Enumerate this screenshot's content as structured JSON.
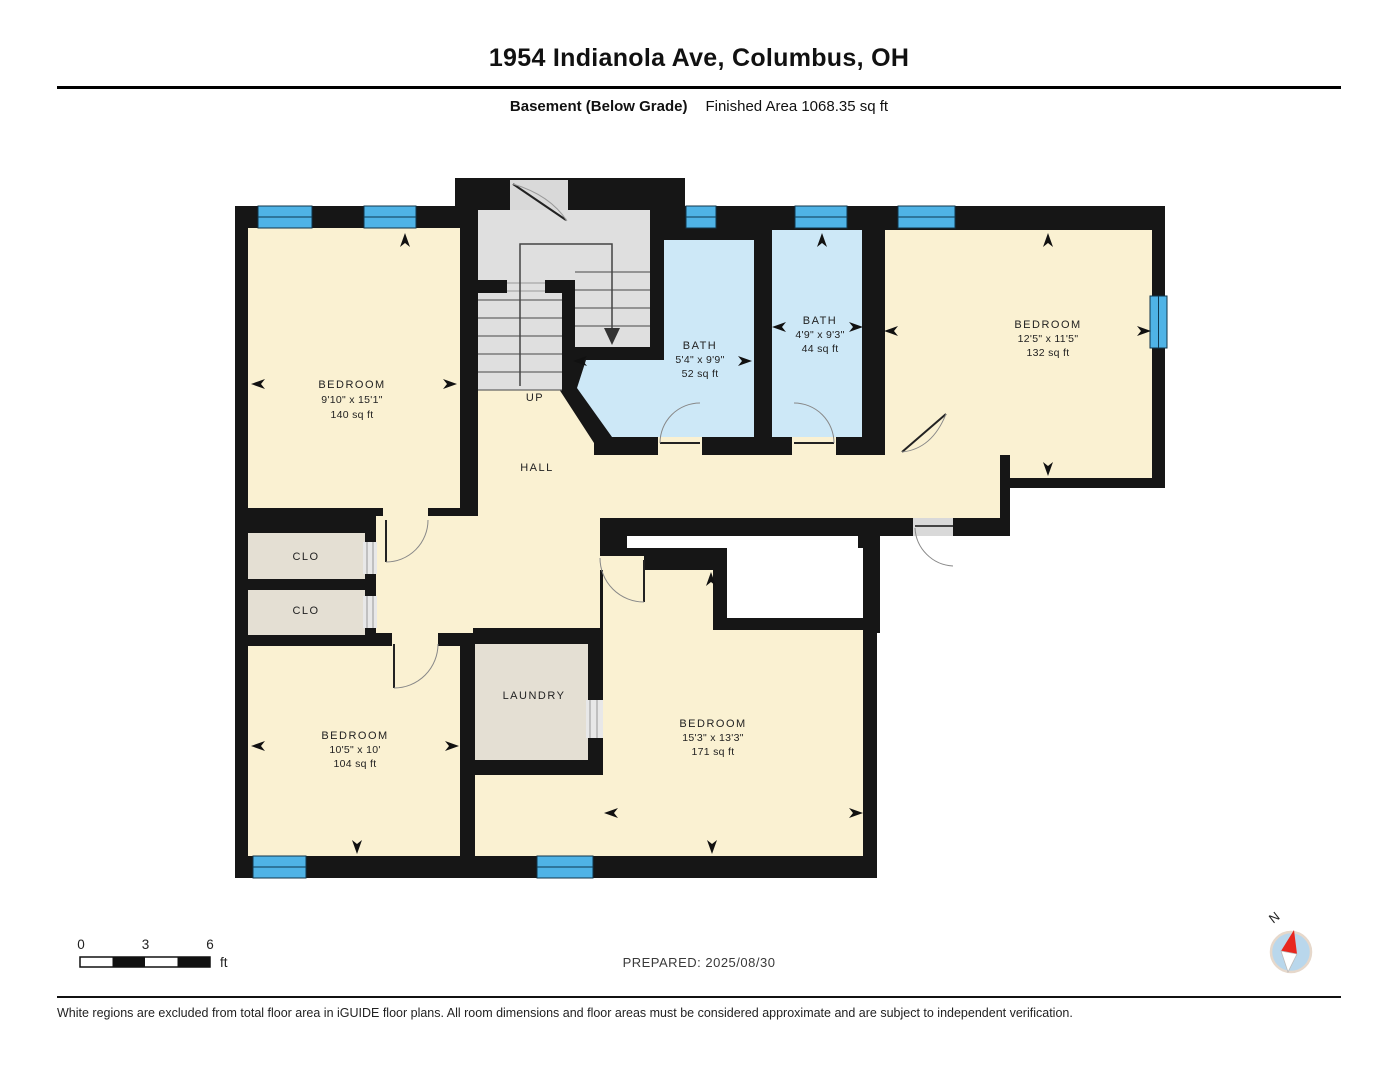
{
  "header": {
    "title": "1954 Indianola Ave, Columbus, OH",
    "floor_label": "Basement (Below Grade)",
    "area_label": "Finished Area 1068.35 sq ft"
  },
  "plan": {
    "rooms": [
      {
        "name": "BEDROOM",
        "dims": "9'10\" x 15'1\"",
        "area": "140 sq ft"
      },
      {
        "name": "BATH",
        "dims": "5'4\" x 9'9\"",
        "area": "52 sq ft"
      },
      {
        "name": "BATH",
        "dims": "4'9\" x 9'3\"",
        "area": "44 sq ft"
      },
      {
        "name": "BEDROOM",
        "dims": "12'5\" x 11'5\"",
        "area": "132 sq ft"
      },
      {
        "name": "BEDROOM",
        "dims": "10'5\" x 10'",
        "area": "104 sq ft"
      },
      {
        "name": "BEDROOM",
        "dims": "15'3\" x 13'3\"",
        "area": "171 sq ft"
      },
      {
        "name": "CLO"
      },
      {
        "name": "CLO"
      },
      {
        "name": "LAUNDRY"
      },
      {
        "name": "HALL"
      },
      {
        "name": "UP"
      }
    ]
  },
  "scale_bar": {
    "tick_start": "0",
    "tick_mid": "3",
    "tick_end": "6",
    "unit": "ft"
  },
  "compass": {
    "north_label": "N"
  },
  "footer": {
    "prepared": "PREPARED: 2025/08/30",
    "disclaimer": "White regions are excluded from total floor area in iGUIDE floor plans. All room dimensions and floor areas must be considered approximate and are subject to independent verification."
  },
  "colors": {
    "room_fill": "#FAF1D2",
    "bath_fill": "#CDE8F7",
    "window": "#4FB3E6",
    "closet_fill": "#E4DFD3",
    "stairs_fill": "#DFDFDF",
    "wall": "#161616"
  }
}
